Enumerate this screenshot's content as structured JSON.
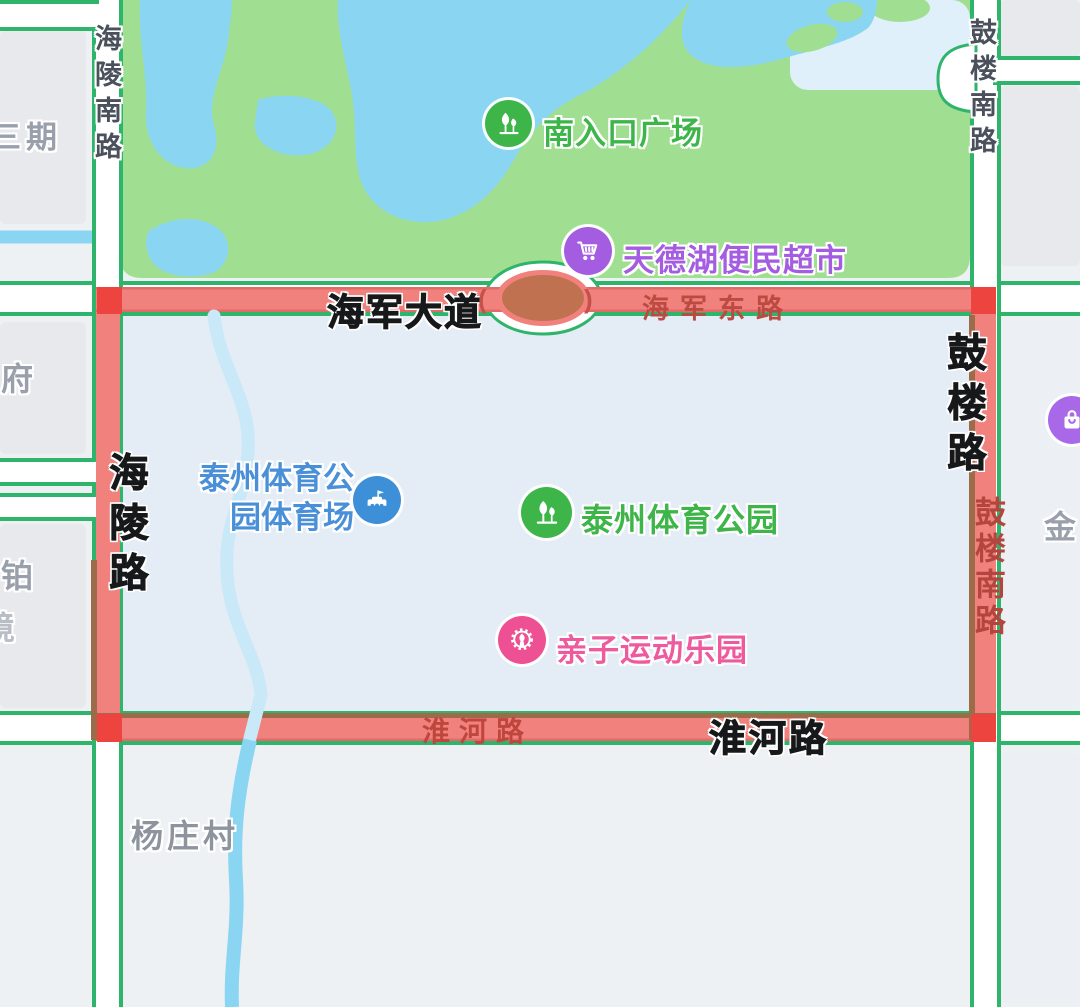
{
  "map_meta": {
    "type": "map-screenshot",
    "description_labels_language": "zh-CN",
    "colors": {
      "highlight_route": "#f0817d",
      "highlight_corner_marker": "#ee4440",
      "road_border_green": "#2fb46c",
      "park_green": "#a0df92",
      "water_blue": "#8ad5f2",
      "selection_fill": "#e4ecf6",
      "poi_green": "#3db549",
      "poi_purple": "#a45ce0",
      "poi_blue": "#4a90d8",
      "poi_pink": "#ee5a9e",
      "roundabout_island": "#bf7150"
    }
  },
  "pois": {
    "south_entrance": {
      "label": "南入口广场"
    },
    "supermarket": {
      "label": "天德湖便民超市"
    },
    "stadium": {
      "line1": "泰州体育公",
      "line2": "园体育场"
    },
    "sports_park": {
      "label": "泰州体育公园"
    },
    "kids_park": {
      "label": "亲子运动乐园"
    }
  },
  "road_labels": {
    "hailing_south_road_top": "海陵南路",
    "gulou_south_road_top": "鼓楼南路",
    "haijun_avenue": "海军大道",
    "haijun_east_road": "海军东路",
    "hailing_road": "海陵路",
    "gulou_road": "鼓楼路",
    "gulou_south_road_right": "鼓楼南路",
    "huaihe_road_on_road": "淮河路",
    "huaihe_road_bold": "淮河路",
    "roundabout_open_mark": "(",
    "roundabout_close_mark": ")"
  },
  "area_labels": {
    "sanqi": "三期",
    "fu": "府",
    "bo": "铂",
    "jing": "境",
    "yangzhuang_village": "杨庄村",
    "jin": "金"
  }
}
